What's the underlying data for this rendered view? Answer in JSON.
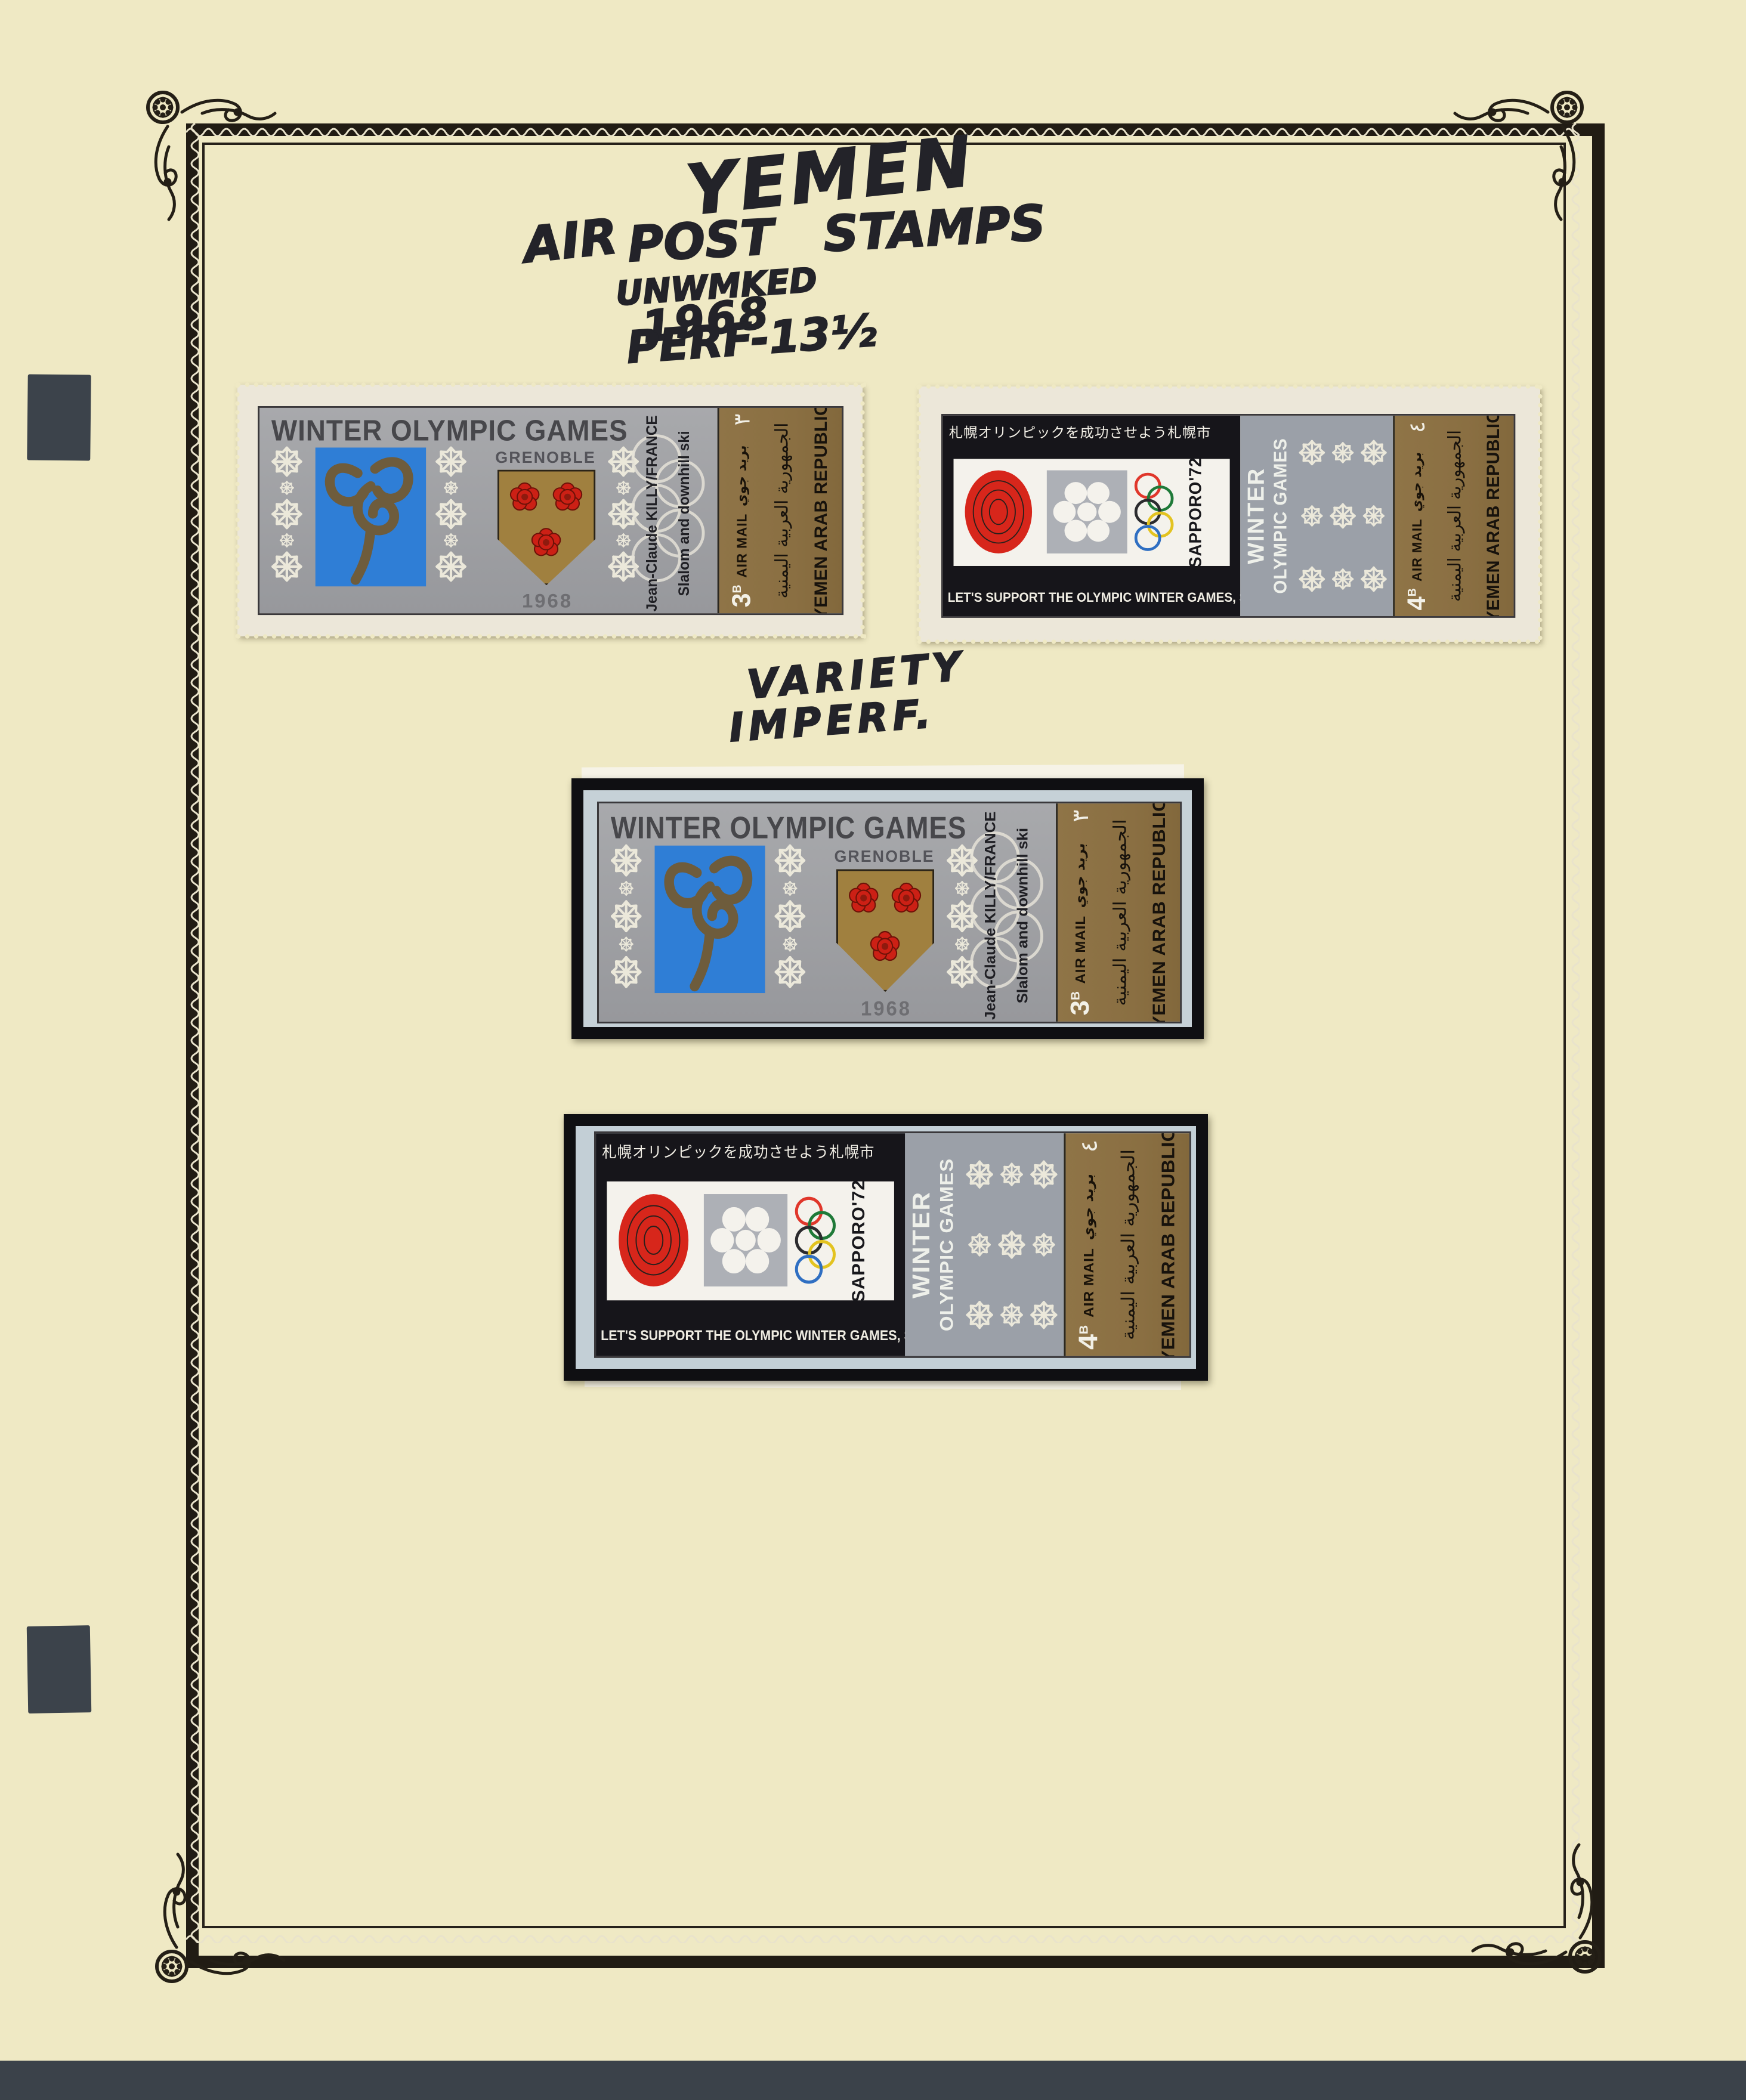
{
  "handwriting": {
    "country": "YEMEN",
    "air": "AIR",
    "post_stamps": "POST STAMPS",
    "watermark_note": "UNWMKED",
    "year": "1968",
    "perforation_note": "PERF-13½",
    "variety_line1": "VARIETY",
    "variety_line2": "IMPERF."
  },
  "stamps": {
    "grenoble": {
      "title": "WINTER OLYMPIC GAMES",
      "city": "GRENOBLE",
      "year": "1968",
      "athlete": "Jean-Claude KILLY/FRANCE",
      "event": "Slalom and downhill ski",
      "value": "3",
      "value_unit": "B",
      "value_arabic": "٣",
      "airmail_en": "AIR MAIL",
      "airmail_ar": "بريد جوي",
      "country_ar": "الجمهورية العربية اليمنية",
      "country_en": "YEMEN ARAB REPUBLIC"
    },
    "sapporo": {
      "japanese_slogan": "札幌オリンピックを成功させよう札幌市",
      "slogan": "LET'S SUPPORT THE OLYMPIC WINTER GAMES, SAPPORO",
      "title_line1": "WINTER",
      "title_line2": "OLYMPIC GAMES",
      "event": "SAPPORO'72",
      "value": "4",
      "value_unit": "B",
      "value_arabic": "٤",
      "airmail_en": "AIR MAIL",
      "airmail_ar": "بريد جوي",
      "country_ar": "الجمهورية العربية اليمنية",
      "country_en": "YEMEN ARAB REPUBLIC"
    }
  },
  "colors": {
    "page": "#efe9c4",
    "frame": "#211c14",
    "stamp_silver": "#a0a1a5",
    "bronze_panel": "#8a6f42",
    "grenoble_blue": "#2f7ed6",
    "rose_red": "#cc2015",
    "sun_red": "#d7261b",
    "mount_black": "#0f0f12",
    "margin_paper": "#c6d1d7",
    "desk": "#3b424a"
  }
}
